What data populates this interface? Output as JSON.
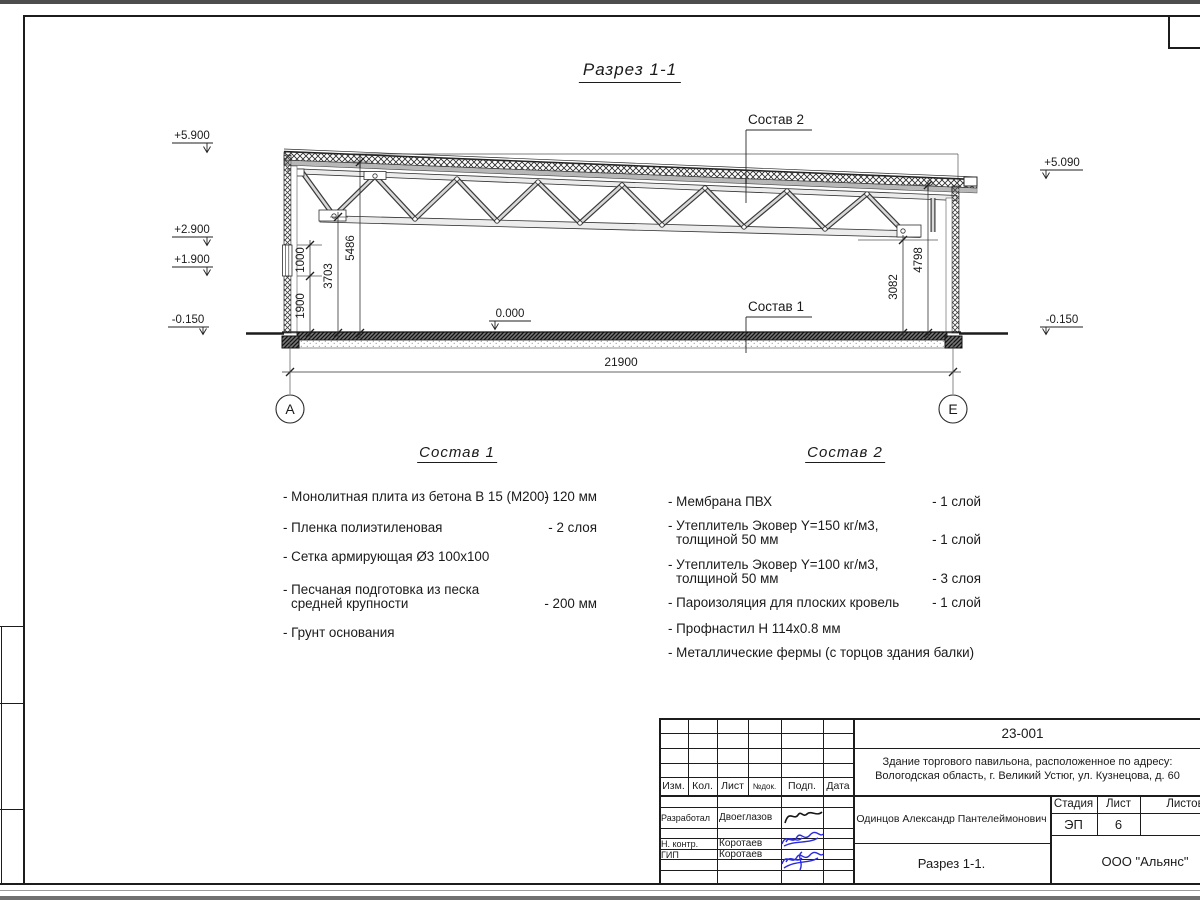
{
  "sheet": {
    "view_title": "Разрез 1-1",
    "axis_a": "А",
    "axis_e": "Е"
  },
  "marks": {
    "e5900": "+5.900",
    "e2900": "+2.900",
    "e1900": "+1.900",
    "em015_left": "-0.150",
    "e5090": "+5.090",
    "em015_right": "-0.150",
    "zero": "0.000"
  },
  "dims": {
    "h1900": "1900",
    "h1000": "1000",
    "h3703": "3703",
    "h5486": "5486",
    "h3082": "3082",
    "h4798": "4798",
    "span": "21900"
  },
  "callouts": {
    "sostav1": "Состав 1",
    "sostav2": "Состав 2"
  },
  "sostav1": {
    "title": "Состав 1",
    "items": [
      {
        "l1": "- Монолитная плита из бетона В 15 (М200)",
        "l2": "",
        "val": "- 120 мм"
      },
      {
        "l1": "- Пленка полиэтиленовая",
        "l2": "",
        "val": "-  2 слоя"
      },
      {
        "l1": "- Сетка армирующая Ø3 100х100",
        "l2": "",
        "val": ""
      },
      {
        "l1": "- Песчаная подготовка из песка",
        "l2": "средней крупности",
        "val": "- 200 мм"
      },
      {
        "l1": "- Грунт основания",
        "l2": "",
        "val": ""
      }
    ]
  },
  "sostav2": {
    "title": "Состав 2",
    "items": [
      {
        "l1": "- Мембрана ПВХ",
        "l2": "",
        "val": "- 1 слой"
      },
      {
        "l1": "- Утеплитель Эковер Y=150 кг/м3,",
        "l2": "толщиной 50 мм",
        "val": "- 1 слой"
      },
      {
        "l1": "- Утеплитель Эковер Y=100 кг/м3,",
        "l2": "толщиной 50 мм",
        "val": "- 3 слоя"
      },
      {
        "l1": "- Пароизоляция для плоских кровель",
        "l2": "",
        "val": "- 1 слой"
      },
      {
        "l1": "- Профнастил Н 114х0.8 мм",
        "l2": "",
        "val": ""
      },
      {
        "l1": "- Металлические фермы (с торцов здания балки)",
        "l2": "",
        "val": ""
      }
    ]
  },
  "titleblock": {
    "doc_number": "23-001",
    "project_line1": "Здание торгового павильона, расположенное по адресу:",
    "project_line2": "Вологодская область, г. Великий Устюг, ул. Кузнецова, д. 60",
    "headers": {
      "izm": "Изм.",
      "kol": "Кол.",
      "list": "Лист",
      "ndok": "№док.",
      "podp": "Подп.",
      "data": "Дата"
    },
    "rows": [
      {
        "role": "Разработал",
        "name": "Двоеглазов"
      },
      {
        "role": "Н. контр.",
        "name": "Коротаев"
      },
      {
        "role": "ГИП",
        "name": "Коротаев"
      }
    ],
    "author": "Одинцов Александр Пантелеймонович",
    "stage_label": "Стадия",
    "sheet_label": "Лист",
    "sheets_label": "Листов",
    "stage": "ЭП",
    "sheet_num": "6",
    "sheets_total": "",
    "caption": "Разрез 1-1.",
    "company": "ООО \"Альянс\""
  }
}
